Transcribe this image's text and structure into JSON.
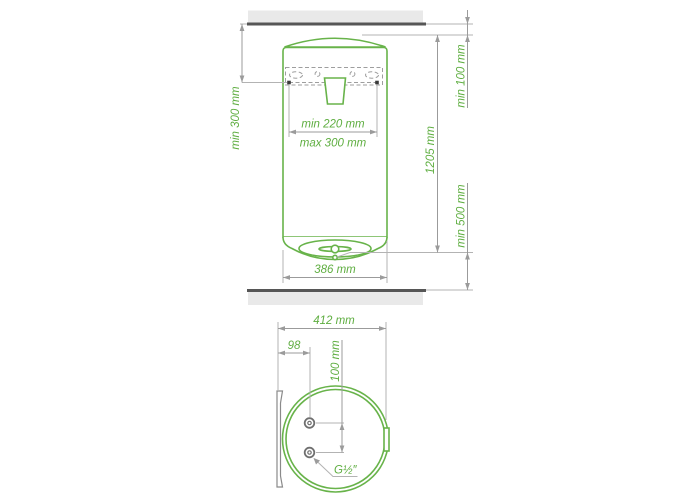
{
  "drawing": {
    "type": "water-heater-installation-dimension-drawing",
    "colors": {
      "outline_green": "#68b34a",
      "label_green": "#5fae41",
      "dimension_gray": "#9b9b9b",
      "surface_fill": "#e9e9e9",
      "surface_edge": "#565656",
      "anchor_black": "#3a3a3a"
    },
    "front_view": {
      "labels": {
        "ceiling_clearance": "min 100 mm",
        "anchor_to_ceiling": "min 300 mm",
        "anchor_spacing_min": "min 220 mm",
        "anchor_spacing_max": "max 300 mm",
        "body_height": "1205 mm",
        "floor_clearance": "min 500 mm",
        "body_width": "386 mm"
      }
    },
    "bottom_view": {
      "labels": {
        "total_depth": "412 mm",
        "pipe_axis_offset": "98",
        "pipe_spacing": "100 mm",
        "pipe_thread": "G½″"
      }
    }
  }
}
